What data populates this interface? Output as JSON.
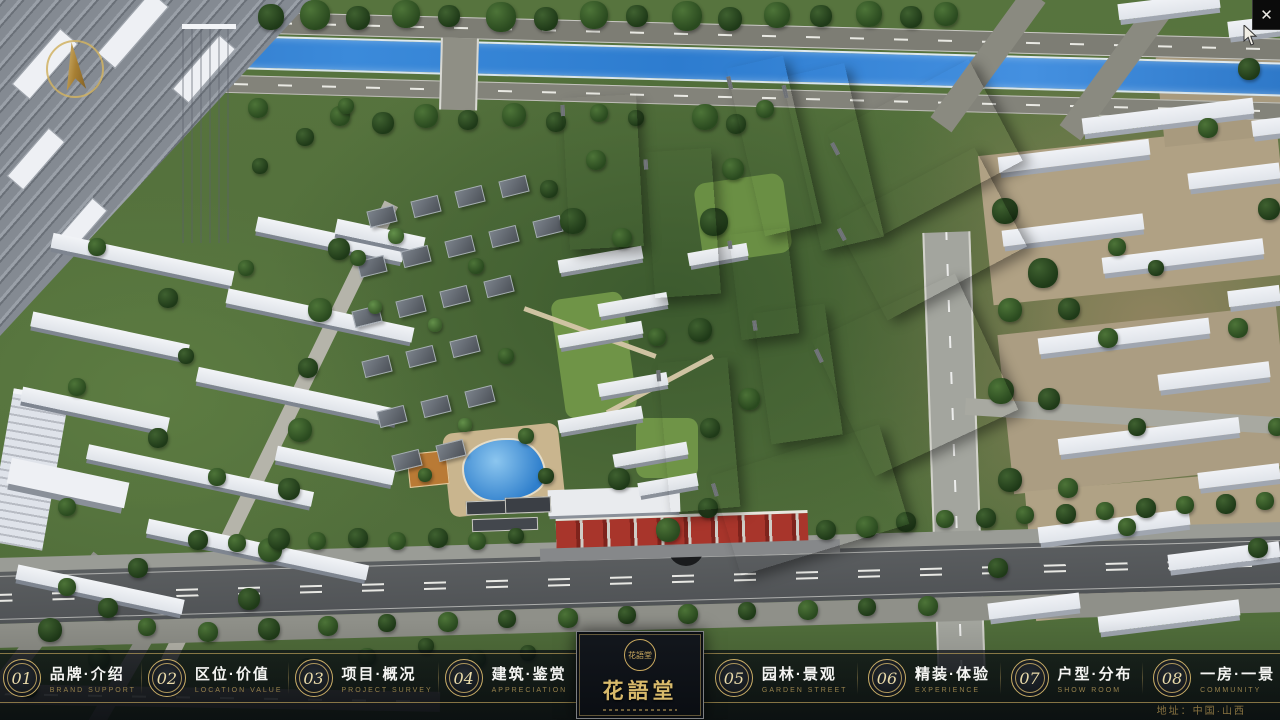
{
  "window": {
    "close_label": "✕"
  },
  "project": {
    "name": "花語堂",
    "location": "地址：中国·山西"
  },
  "logo": {
    "name": "花語堂",
    "seal_text": "花語堂"
  },
  "menu": {
    "items": [
      {
        "num": "01",
        "zh": "品牌·介绍",
        "en": "BRAND SUPPORT"
      },
      {
        "num": "02",
        "zh": "区位·价值",
        "en": "LOCATION VALUE"
      },
      {
        "num": "03",
        "zh": "项目·概况",
        "en": "PROJECT SURVEY"
      },
      {
        "num": "04",
        "zh": "建筑·鉴赏",
        "en": "APPRECIATION"
      },
      {
        "num": "05",
        "zh": "园林·景观",
        "en": "GARDEN STREET"
      },
      {
        "num": "06",
        "zh": "精装·体验",
        "en": "EXPERIENCE"
      },
      {
        "num": "07",
        "zh": "户型·分布",
        "en": "SHOW ROOM"
      },
      {
        "num": "08",
        "zh": "一房·一景",
        "en": "COMMUNITY"
      }
    ]
  },
  "colors": {
    "accent_gold": "#c9ad66",
    "river_blue": "#2d7fd0",
    "bar_background": "rgba(8,12,18,0.8)"
  }
}
